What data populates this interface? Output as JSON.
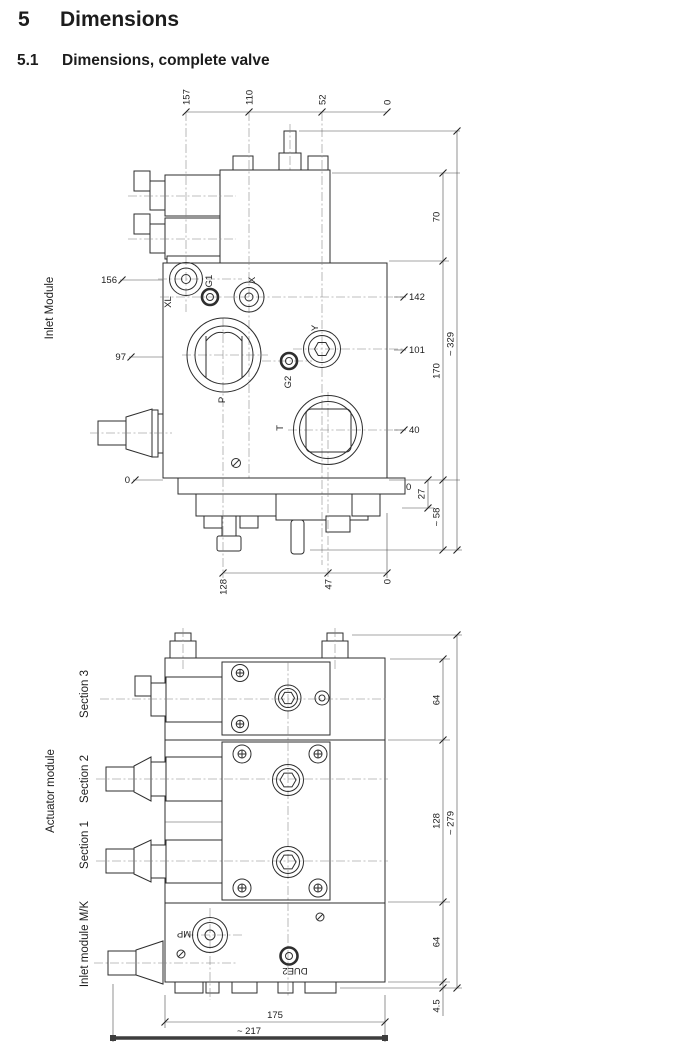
{
  "page": {
    "section_number": "5",
    "section_title": "Dimensions",
    "subsection_number": "5.1",
    "subsection_title": "Dimensions, complete valve"
  },
  "inlet_drawing": {
    "module_label": "Inlet Module",
    "ports": {
      "xl": "XL",
      "g1": "G1",
      "x": "X",
      "y": "Y",
      "g2": "G2",
      "p": "P",
      "t": "T"
    },
    "dims_top": {
      "d157": "157",
      "d110": "110",
      "d52": "52",
      "d0": "0"
    },
    "dims_left": {
      "d156": "156",
      "d97": "97",
      "d0": "0"
    },
    "dims_right": {
      "d142": "142",
      "d101": "101",
      "d40": "40",
      "d0": "0",
      "d70": "70",
      "d170": "170",
      "d329": "~ 329",
      "d27": "27",
      "d58": "~ 58"
    },
    "dims_bottom": {
      "d128": "128",
      "d47": "47",
      "d0": "0"
    }
  },
  "assembly_drawing": {
    "group_label": "Actuator module",
    "section3_label": "Section 3",
    "section2_label": "Section 2",
    "section1_label": "Section 1",
    "inlet_label": "Inlet module M/K",
    "ports": {
      "mp": "MP",
      "due2": "DUE2"
    },
    "dims_right": {
      "d64_top": "64",
      "d128": "128",
      "d279": "~ 279",
      "d64_bottom": "64",
      "d4_5": "4.5"
    },
    "dims_bottom": {
      "d175": "175",
      "d217": "~ 217"
    }
  }
}
